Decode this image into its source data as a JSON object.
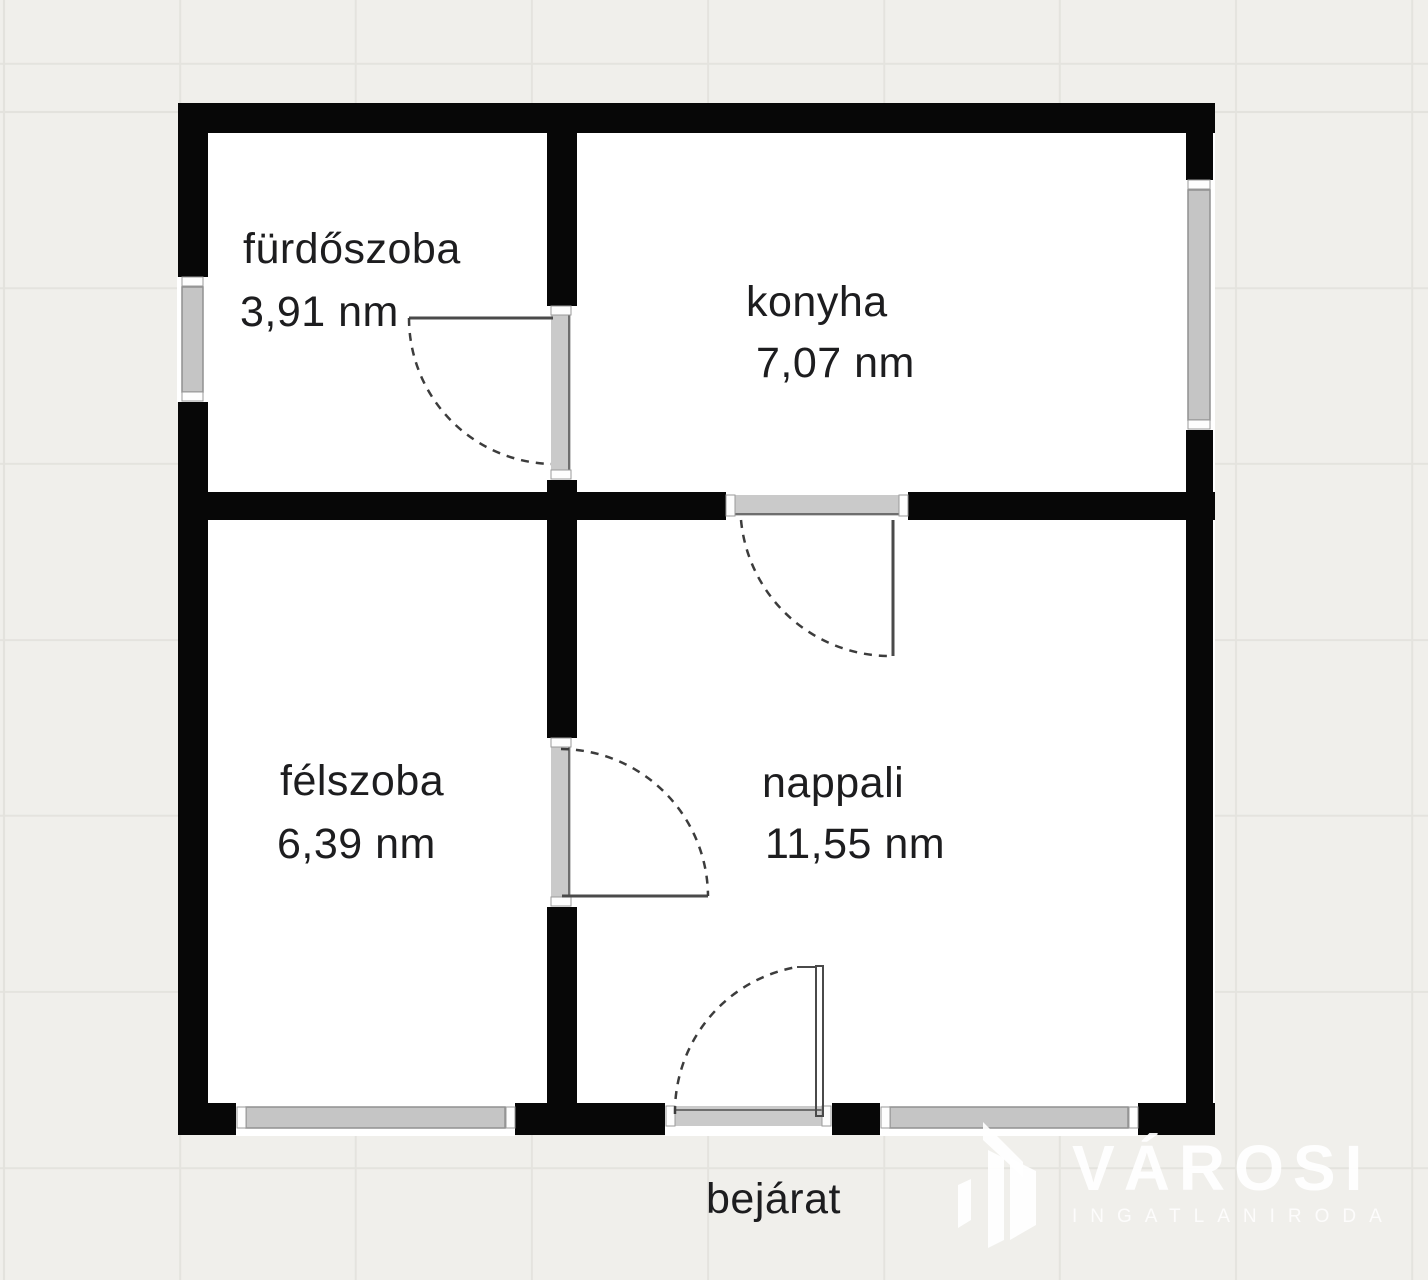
{
  "plan": {
    "rooms": [
      {
        "id": "furdoszoba",
        "name": "fürdőszoba",
        "area": "3,91 nm"
      },
      {
        "id": "konyha",
        "name": "konyha",
        "area": "7,07 nm"
      },
      {
        "id": "felszoba",
        "name": "félszoba",
        "area": "6,39 nm"
      },
      {
        "id": "nappali",
        "name": "nappali",
        "area": "11,55 nm"
      }
    ],
    "entrance_label": "bejárat"
  },
  "watermark": {
    "brand": "VÁROSI",
    "tagline": "INGATLANIRODA"
  },
  "colors": {
    "background": "#f0efeb",
    "grid_line": "#e3e2dd",
    "wall": "#070707",
    "room_fill": "#ffffff",
    "window_glass": "#c5c5c5",
    "door_threshold": "#cacaca",
    "door_swing": "#3c3c3c",
    "label_text": "#1d1d1f",
    "watermark_text": "#ffffff"
  }
}
